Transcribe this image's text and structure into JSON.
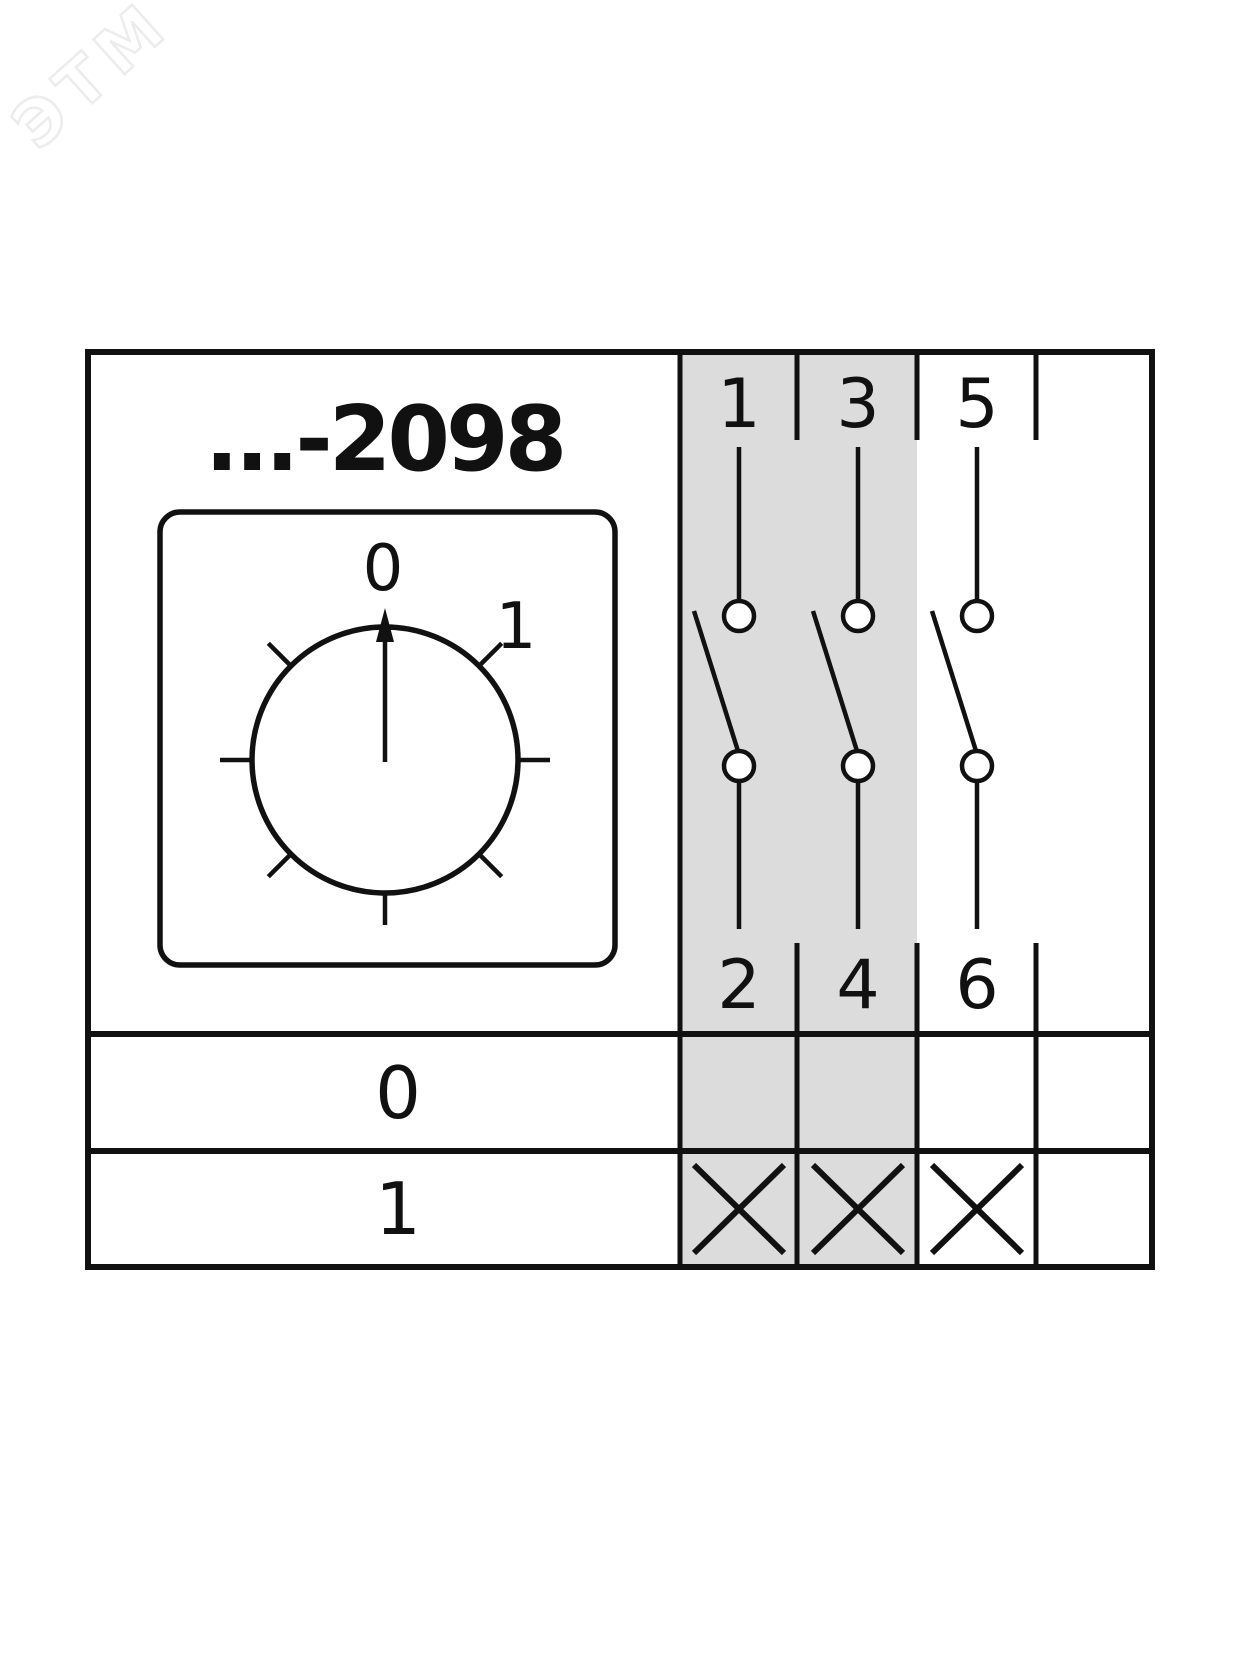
{
  "colors": {
    "background": "#ffffff",
    "ink": "#111111",
    "shaded_band": "#dcdcdc",
    "watermark": "#ececec"
  },
  "watermark": {
    "text": "ЭТМ",
    "logo": "striped-globe-icon"
  },
  "diagram": {
    "title": "...-2098",
    "dial": {
      "position_labels": [
        "0",
        "1"
      ],
      "selected_position": "0",
      "tick_count": 8,
      "pointer_direction": "up"
    },
    "contacts": {
      "poles": [
        {
          "top": "1",
          "bottom": "2",
          "state": "open"
        },
        {
          "top": "3",
          "bottom": "4",
          "state": "open"
        },
        {
          "top": "5",
          "bottom": "6",
          "state": "open"
        }
      ]
    },
    "table": {
      "rows": [
        {
          "position": "0",
          "closed": [
            false,
            false,
            false
          ]
        },
        {
          "position": "1",
          "closed": [
            true,
            true,
            true
          ]
        }
      ]
    }
  }
}
